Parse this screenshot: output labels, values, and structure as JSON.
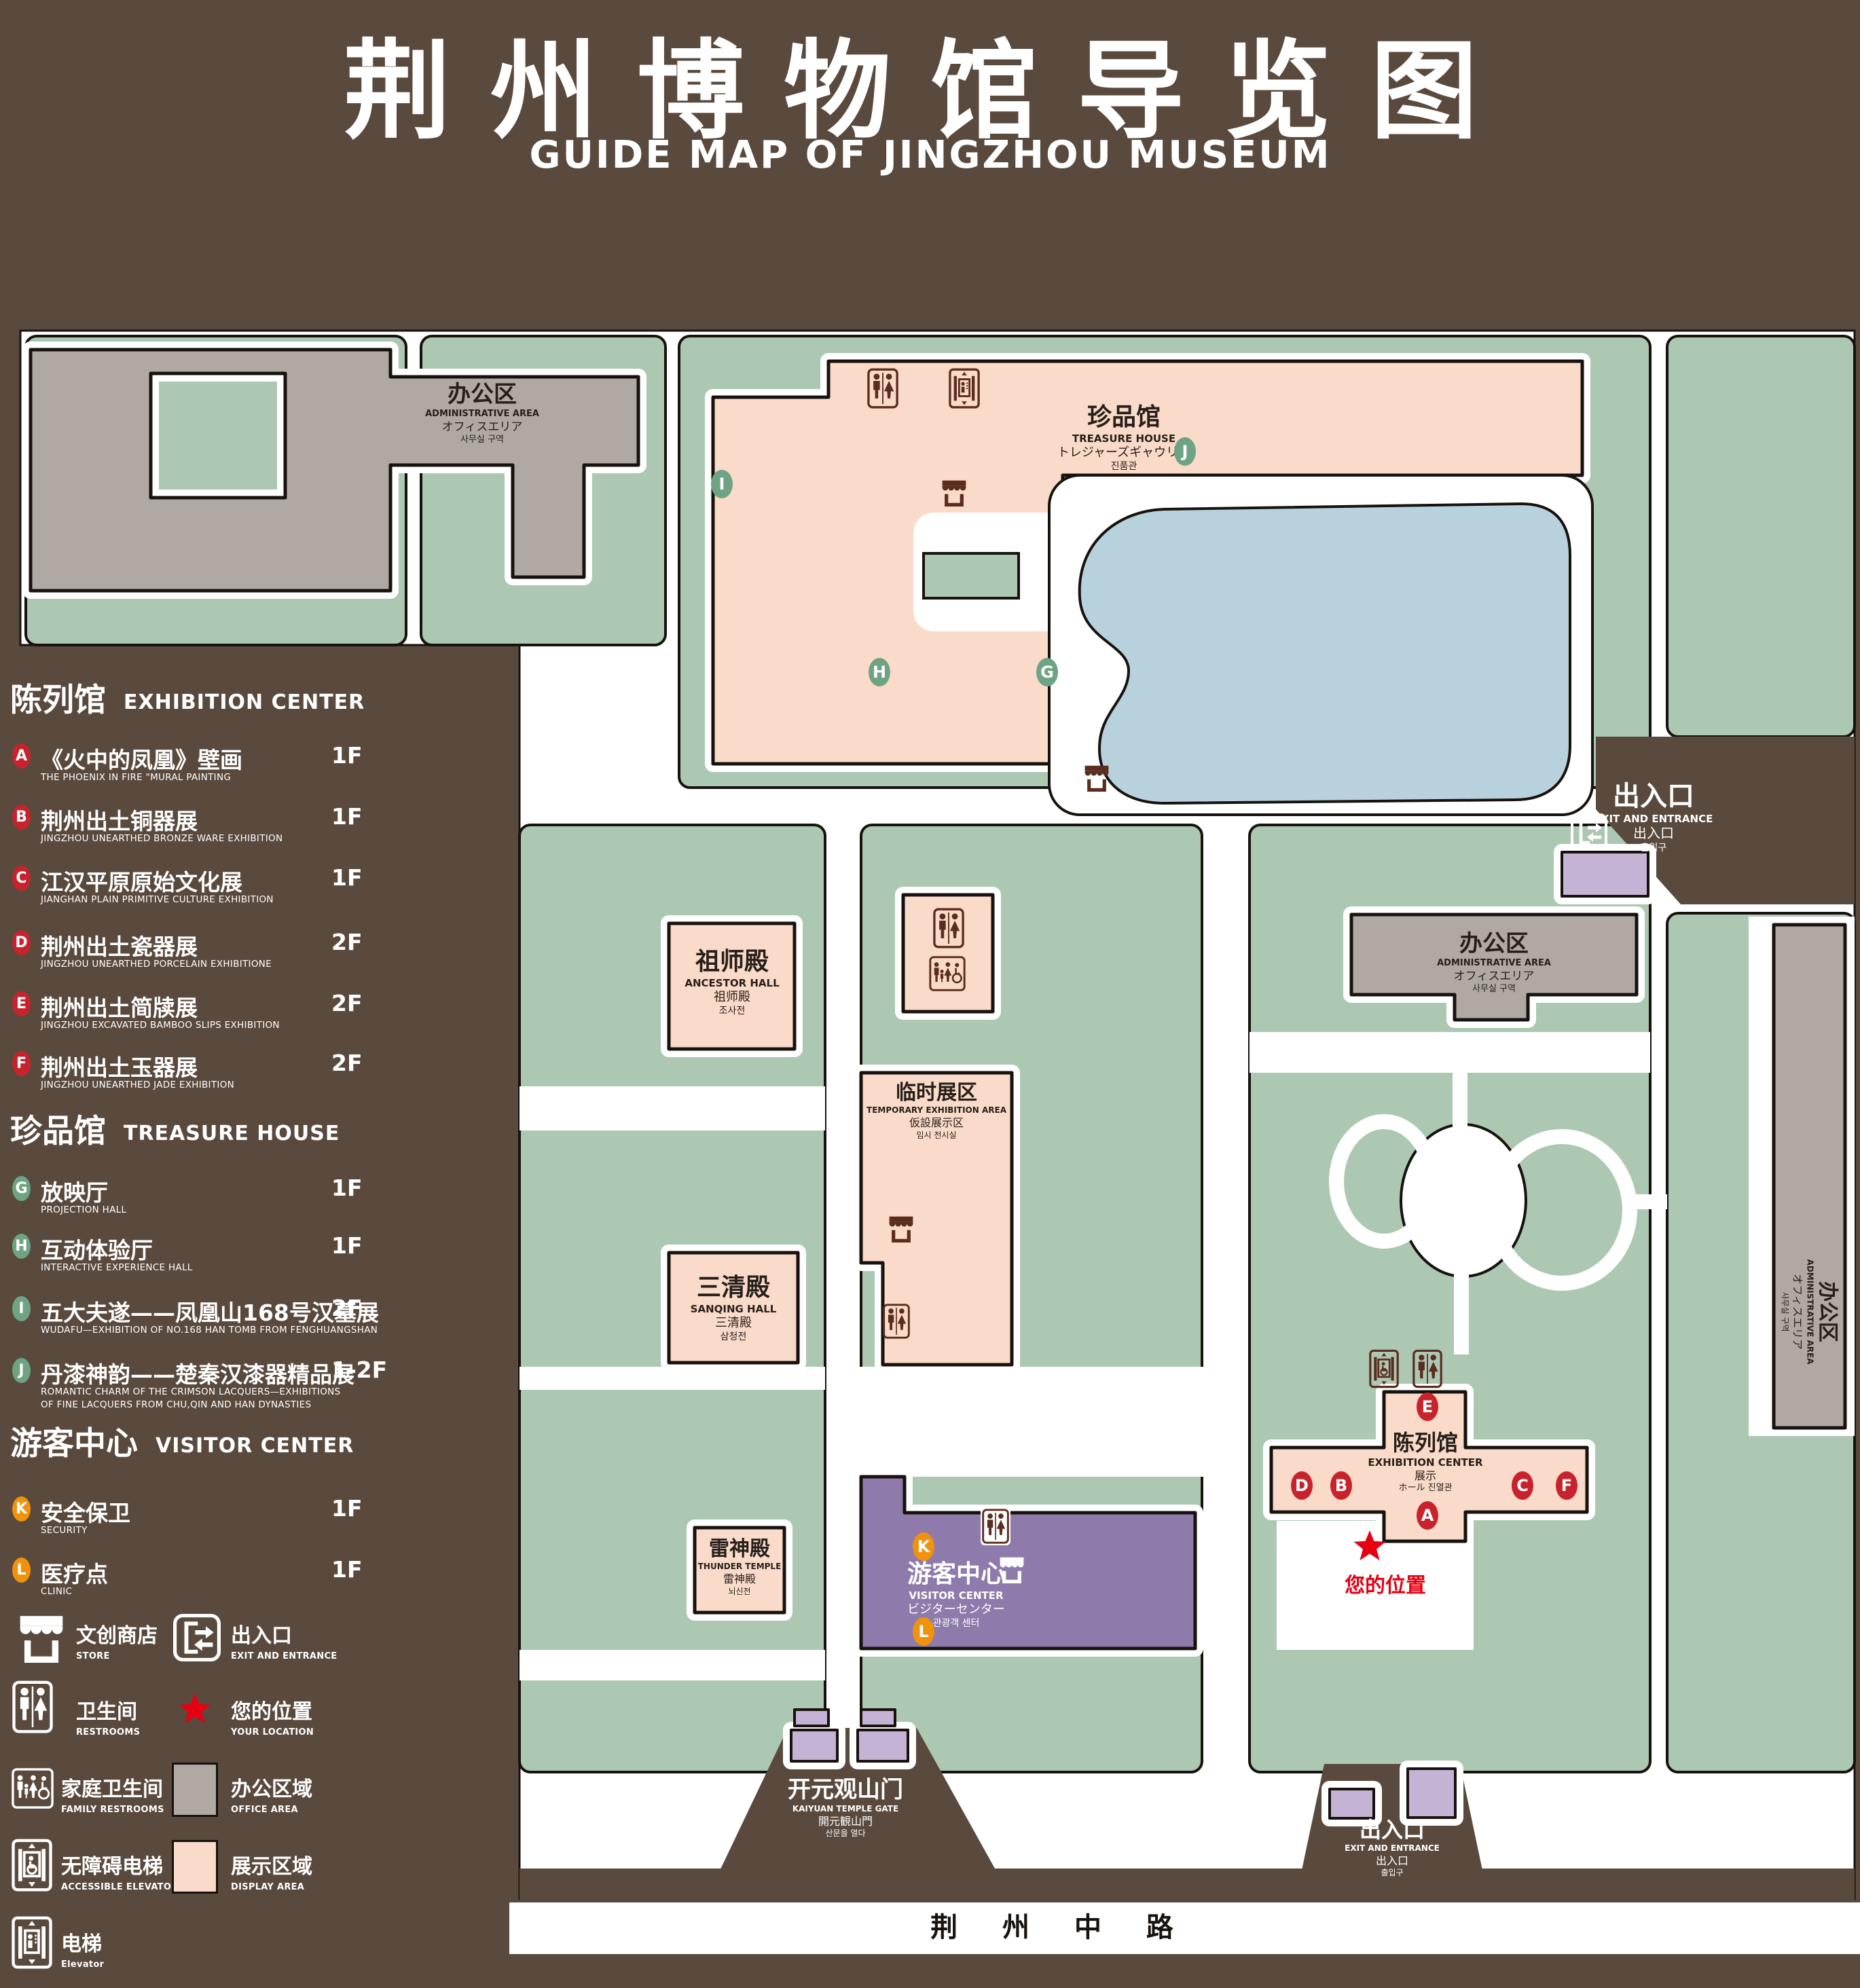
{
  "page": {
    "title_cn": "荆州博物馆导览图",
    "title_en": "GUIDE MAP OF JINGZHOU MUSEUM"
  },
  "colors": {
    "background_brown": "#5a4a3e",
    "lawn_green": "#adc8b2",
    "display_area_pink": "#fadac8",
    "office_area_gray": "#b0a9a3",
    "pond_blue": "#b7d2dc",
    "visitor_center_purple": "#8e7bab",
    "gate_purple": "#c4b3d4",
    "marker_red": "#c8232c",
    "marker_green": "#6ea383",
    "marker_orange": "#f1920e",
    "location_red": "#e60012",
    "icon_brown": "#5b2d20"
  },
  "legend": {
    "sections": [
      {
        "heading_cn": "陈列馆",
        "heading_en": "EXHIBITION CENTER",
        "items": [
          {
            "id": "A",
            "name_cn": "《火中的凤凰》壁画",
            "name_en": "THE PHOENIX IN FIRE \"MURAL PAINTING",
            "floor": "1F"
          },
          {
            "id": "B",
            "name_cn": "荆州出土铜器展",
            "name_en": "JINGZHOU UNEARTHED BRONZE WARE EXHIBITION",
            "floor": "1F"
          },
          {
            "id": "C",
            "name_cn": "江汉平原原始文化展",
            "name_en": "JIANGHAN PLAIN PRIMITIVE CULTURE EXHIBITION",
            "floor": "1F"
          },
          {
            "id": "D",
            "name_cn": "荆州出土瓷器展",
            "name_en": "JINGZHOU UNEARTHED PORCELAIN EXHIBITIONE",
            "floor": "2F"
          },
          {
            "id": "E",
            "name_cn": "荆州出土简牍展",
            "name_en": "JINGZHOU EXCAVATED BAMBOO SLIPS EXHIBITION",
            "floor": "2F"
          },
          {
            "id": "F",
            "name_cn": "荆州出土玉器展",
            "name_en": "JINGZHOU UNEARTHED JADE EXHIBITION",
            "floor": "2F"
          }
        ]
      },
      {
        "heading_cn": "珍品馆",
        "heading_en": "TREASURE HOUSE",
        "items": [
          {
            "id": "G",
            "name_cn": "放映厅",
            "name_en": "PROJECTION HALL",
            "floor": "1F"
          },
          {
            "id": "H",
            "name_cn": "互动体验厅",
            "name_en": "INTERACTIVE EXPERIENCE HALL",
            "floor": "1F"
          },
          {
            "id": "I",
            "name_cn": "五大夫遂——凤凰山168号汉墓展",
            "name_en": "WUDAFU—EXHIBITION OF NO.168 HAN TOMB FROM FENGHUANGSHAN",
            "floor": "2F"
          },
          {
            "id": "J",
            "name_cn": "丹漆神韵——楚秦汉漆器精品展",
            "name_en": "ROMANTIC CHARM OF THE CRIMSON LACQUERS—EXHIBITIONS",
            "name_en2": "OF FINE LACQUERS FROM CHU,QIN AND HAN DYNASTIES",
            "floor": "1-2F"
          }
        ]
      },
      {
        "heading_cn": "游客中心",
        "heading_en": "VISITOR CENTER",
        "items": [
          {
            "id": "K",
            "name_cn": "安全保卫",
            "name_en": "SECURITY",
            "floor": "1F"
          },
          {
            "id": "L",
            "name_cn": "医疗点",
            "name_en": "CLINIC",
            "floor": "1F"
          }
        ]
      }
    ],
    "symbols": [
      {
        "icon": "store-icon",
        "label_cn": "文创商店",
        "label_en": "STORE"
      },
      {
        "icon": "exit-icon",
        "label_cn": "出入口",
        "label_en": "EXIT AND ENTRANCE"
      },
      {
        "icon": "restrooms-icon",
        "label_cn": "卫生间",
        "label_en": "RESTROOMS"
      },
      {
        "icon": "location-star-icon",
        "label_cn": "您的位置",
        "label_en": "YOUR LOCATION"
      },
      {
        "icon": "family-restrooms-icon",
        "label_cn": "家庭卫生间",
        "label_en": "FAMILY RESTROOMS"
      },
      {
        "icon": "office-area-swatch",
        "label_cn": "办公区域",
        "label_en": "OFFICE AREA"
      },
      {
        "icon": "accessible-elevator-icon",
        "label_cn": "无障碍电梯",
        "label_en": "ACCESSIBLE ELEVATOR"
      },
      {
        "icon": "display-area-swatch",
        "label_cn": "展示区域",
        "label_en": "DISPLAY AREA"
      },
      {
        "icon": "elevator-icon",
        "label_cn": "电梯",
        "label_en": "Elevator"
      }
    ]
  },
  "map": {
    "labels": {
      "admin": {
        "l1": "办公区",
        "l2": "ADMINISTRATIVE AREA",
        "l3": "オフィスエリア",
        "l4": "사무실 구역"
      },
      "treasure": {
        "l1": "珍品馆",
        "l2": "TREASURE HOUSE",
        "l3": "トレジャーズギャウリー",
        "l4": "진품관"
      },
      "ancestor": {
        "l1": "祖师殿",
        "l2": "ANCESTOR HALL",
        "l3": "祖师殿",
        "l4": "조사전"
      },
      "sanqing": {
        "l1": "三清殿",
        "l2": "SANQING HALL",
        "l3": "三清殿",
        "l4": "삼청전"
      },
      "thunder": {
        "l1": "雷神殿",
        "l2": "THUNDER TEMPLE",
        "l3": "雷神殿",
        "l4": "뇌신전"
      },
      "temporary": {
        "l1": "临时展区",
        "l2": "TEMPORARY EXHIBITION AREA",
        "l3": "仮設展示区",
        "l4": "임시 전시실"
      },
      "visitor": {
        "l1": "游客中心",
        "l2": "VISITOR CENTER",
        "l3": "ビジターセンター",
        "l4": "관광객 센터"
      },
      "exhibition": {
        "l1": "陈列馆",
        "l2": "EXHIBITION CENTER",
        "l3": "展示",
        "l4": "ホール 진열관"
      },
      "ne_exit": {
        "l1": "出入口",
        "l2": "EXIT AND ENTRANCE",
        "l3": "出入口",
        "l4": "출입구"
      },
      "s_exit": {
        "l1": "出入口",
        "l2": "EXIT AND ENTRANCE",
        "l3": "出入口",
        "l4": "출입구"
      },
      "gate": {
        "l1": "开元观山门",
        "l2": "KAIYUAN TEMPLE GATE",
        "l3": "開元観山門",
        "l4": "산문을 열다"
      },
      "road": "荆 州 中 路",
      "your_location": "您的位置"
    },
    "markers": [
      {
        "letter": "A"
      },
      {
        "letter": "B"
      },
      {
        "letter": "C"
      },
      {
        "letter": "D"
      },
      {
        "letter": "E"
      },
      {
        "letter": "F"
      },
      {
        "letter": "G"
      },
      {
        "letter": "H"
      },
      {
        "letter": "I"
      },
      {
        "letter": "J"
      },
      {
        "letter": "K"
      },
      {
        "letter": "L"
      }
    ]
  }
}
